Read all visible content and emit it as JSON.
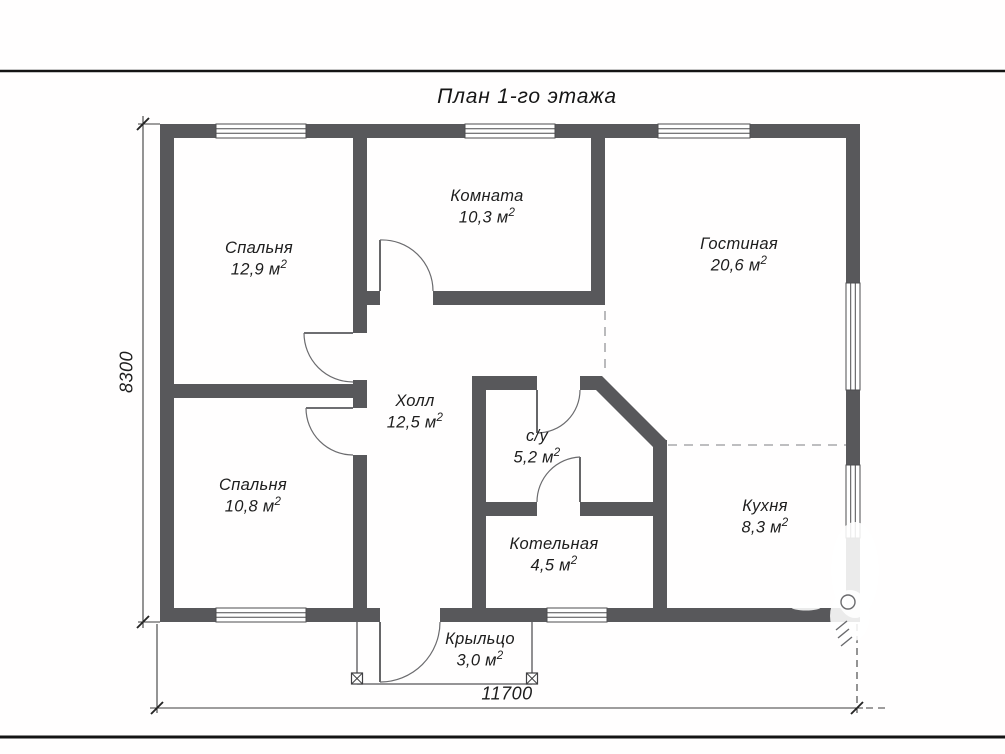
{
  "title": "План 1-го этажа",
  "rooms": [
    {
      "name": "Спальня",
      "area": "12,9 м",
      "area_sup": "2"
    },
    {
      "name": "Комната",
      "area": "10,3 м",
      "area_sup": "2"
    },
    {
      "name": "Гостиная",
      "area": "20,6 м",
      "area_sup": "2"
    },
    {
      "name": "Холл",
      "area": "12,5 м",
      "area_sup": "2"
    },
    {
      "name": "с/у",
      "area": "5,2 м",
      "area_sup": "2"
    },
    {
      "name": "Спальня",
      "area": "10,8 м",
      "area_sup": "2"
    },
    {
      "name": "Котельная",
      "area": "4,5 м",
      "area_sup": "2"
    },
    {
      "name": "Кухня",
      "area": "8,3 м",
      "area_sup": "2"
    },
    {
      "name": "Крыльцо",
      "area": "3,0 м",
      "area_sup": "2"
    }
  ],
  "dimensions": {
    "width_mm": "11700",
    "height_mm": "8300"
  },
  "colors": {
    "wall": "#58585b",
    "frame_line": "#141414",
    "dashed_boundary": "#a9a9ab"
  }
}
